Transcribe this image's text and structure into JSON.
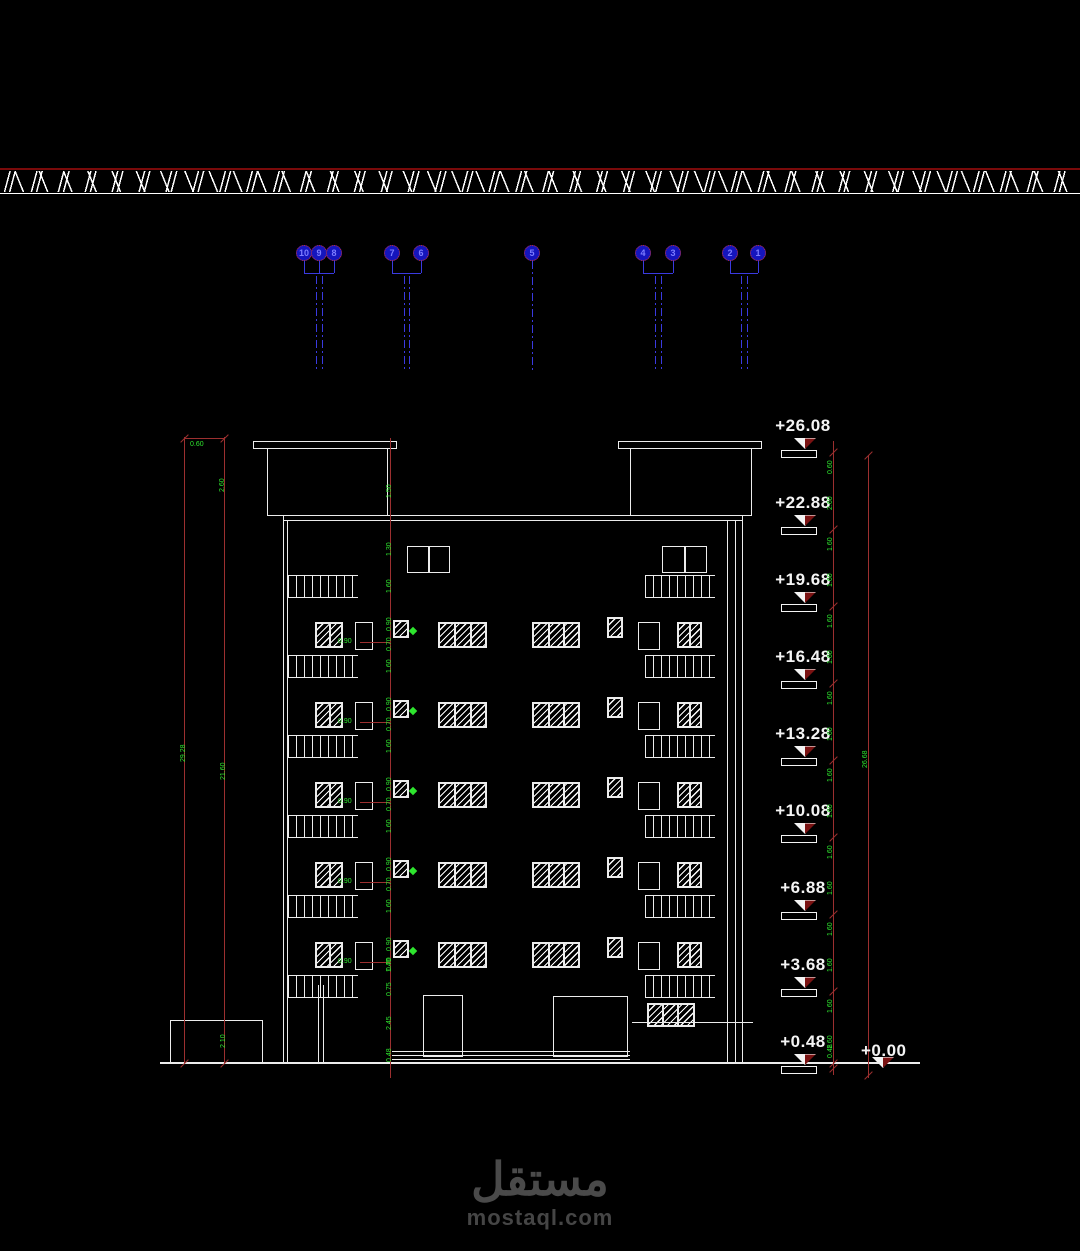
{
  "drawing_title": "building-front-elevation",
  "levels": [
    "+26.08",
    "+22.88",
    "+19.68",
    "+16.48",
    "+13.28",
    "+10.08",
    "+6.88",
    "+3.68",
    "+0.48"
  ],
  "datum_label": "+0.00",
  "column_grid": [
    "10",
    "9",
    "8",
    "7",
    "6",
    "5",
    "4",
    "3",
    "2",
    "1"
  ],
  "dim_chain_right": [
    "0.60",
    "2.60",
    "1.60",
    "1.60",
    "1.60",
    "1.60",
    "1.60",
    "1.60",
    "1.60",
    "1.60",
    "1.60",
    "1.60",
    "1.60",
    "1.60",
    "1.60",
    "1.60",
    "0.48"
  ],
  "dim_total_right": "26.68",
  "dims_left": {
    "top": "0.60",
    "upper": "2.60",
    "outer_total": "29.28",
    "inner_total": "21.60",
    "bottom": "2.10"
  },
  "dim_center": {
    "roof": [
      "1.50",
      "1.30"
    ],
    "per_floor": [
      "1.60",
      "0.90",
      "0.70"
    ],
    "ground": [
      "1.40",
      "0.75",
      "2.45",
      "0.48"
    ]
  },
  "floor_leader_label": "0.90",
  "watermark": {
    "logo": "مستقل",
    "site": "mostaql.com"
  },
  "colors": {
    "line_white": "#ececec",
    "dim_red": "#9c2f2f",
    "aux_green": "#2ee52e",
    "grid_blue": "#3a3ae0",
    "circle_fill": "#1515bd",
    "circle_outline": "#cc3333",
    "datum_maroon": "#7a1212",
    "ground_hatch_red": "#7a0a0a",
    "watermark_gray": "#4a4a4a"
  }
}
